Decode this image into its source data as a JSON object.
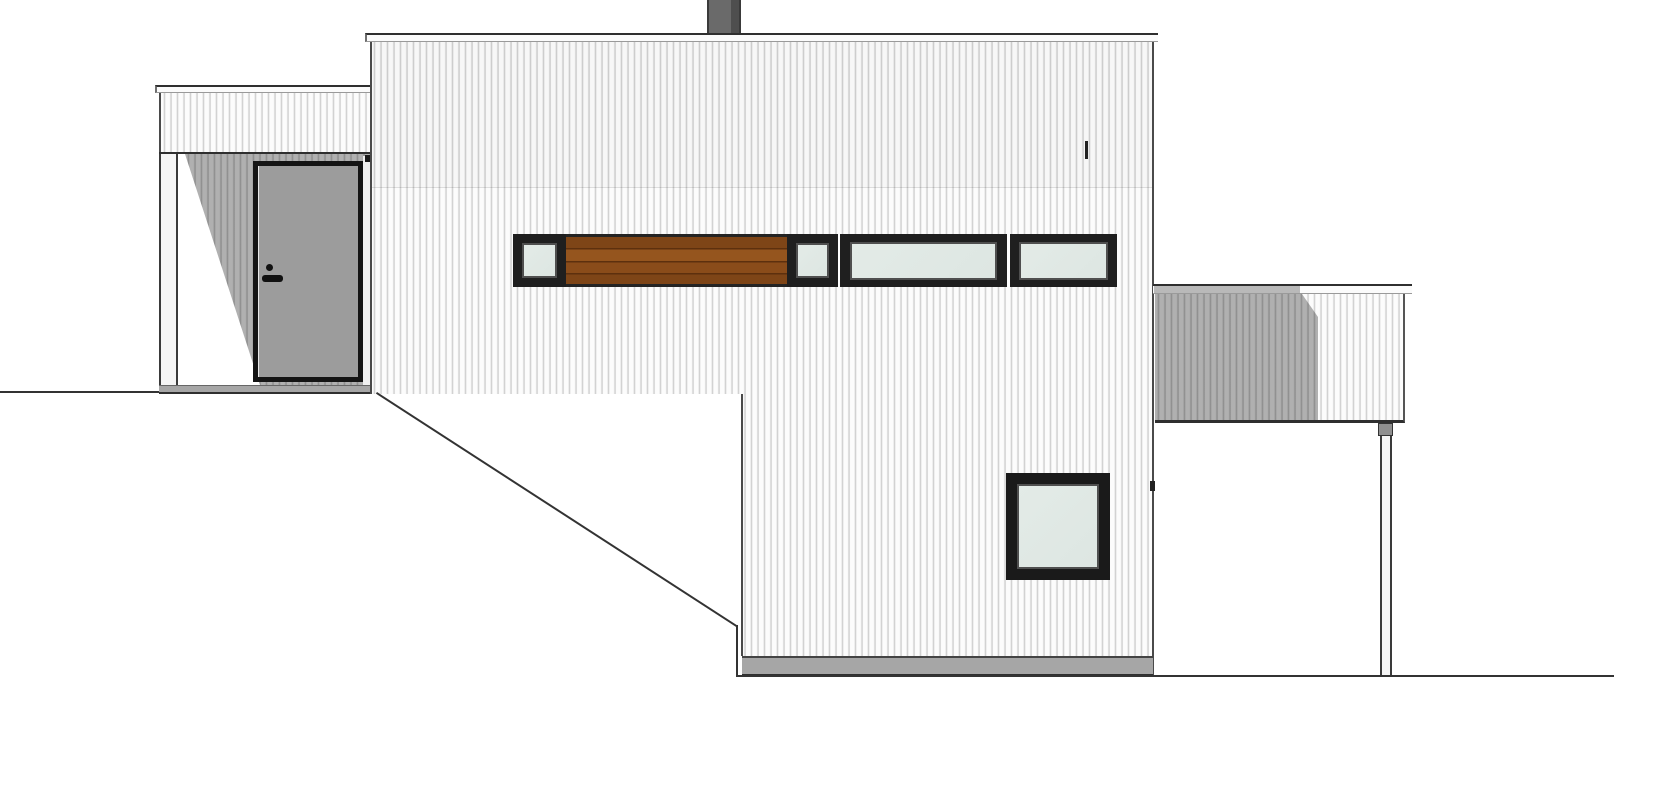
{
  "document": {
    "kind": "architectural side elevation drawing",
    "title": "house-side-elevation",
    "visible_text": "",
    "parts": {
      "entry_wing": "single-story entrance wing with recessed porch, corner post and front door",
      "entry_door": "grey entrance door with dark frame, knob and lever handle",
      "main_volume": "two-story main volume with vertical board siding and flat roof",
      "chimney": "grey chimney stack at roof center",
      "window_band": "horizontal band: small window, wood slat panel, small window, wide window, medium window",
      "wood_panel": "horizontal wood plank infill panel between windows",
      "square_window": "square window on lower walk-out story",
      "terrace": "right-side terrace railing clad in siding with support post",
      "terrain": "ground line stepping down a slope from left to right"
    }
  },
  "palette": {
    "paper": "#ffffff",
    "outline": "#2f2f2f",
    "line_soft": "#9a9a9a",
    "cap_white": "#fbfbfb",
    "siding_a": "#fcfcfc",
    "siding_b": "#c9c9c9",
    "siding_c": "#ececec",
    "shadow_a": "#b0b0b0",
    "shadow_b": "#8a8a8a",
    "shadow_c": "#a2a2a2",
    "frame_dark": "#1f1f1f",
    "frame_mid": "#4f4f4f",
    "glass": "#dde6e2",
    "wood_a": "#95551e",
    "wood_b": "#7e4517",
    "wood_c": "#8a4c1a",
    "wood_line": "#5d300e",
    "door_panel": "#9c9c9c",
    "chimney": "#6a6a6a",
    "chimney_dark": "#4e4e4e",
    "plinth": "#a6a6a6",
    "post_white": "#f5f5f5",
    "ground": "#333333"
  }
}
